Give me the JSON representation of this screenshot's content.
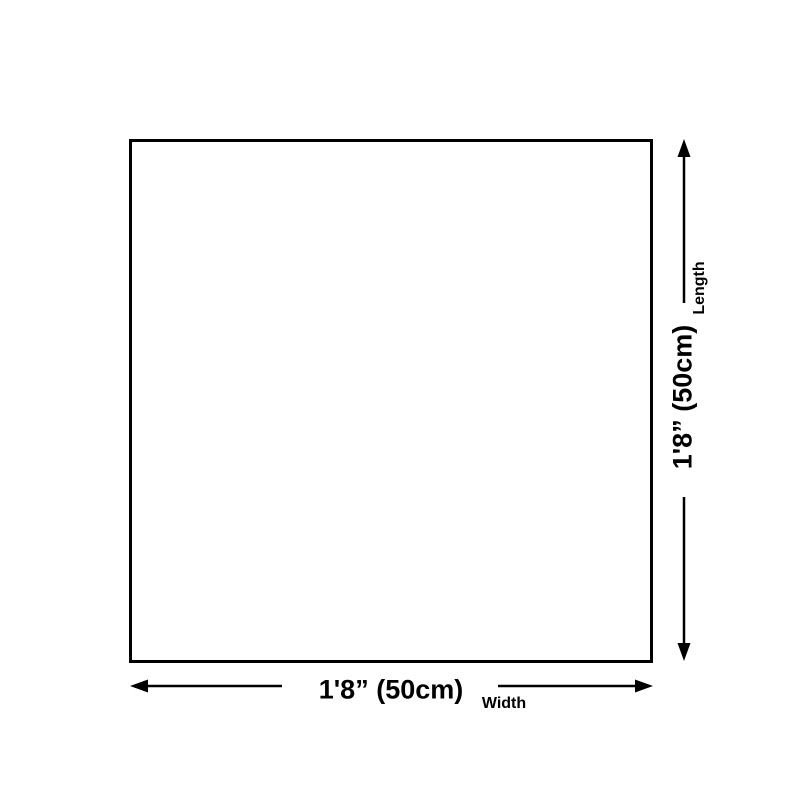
{
  "colors": {
    "line": "#000000",
    "background": "#ffffff"
  },
  "diagram": {
    "length": {
      "label": "Length",
      "value": "1'8” (50cm)"
    },
    "width": {
      "label": "Width",
      "value": "1'8” (50cm)"
    }
  }
}
